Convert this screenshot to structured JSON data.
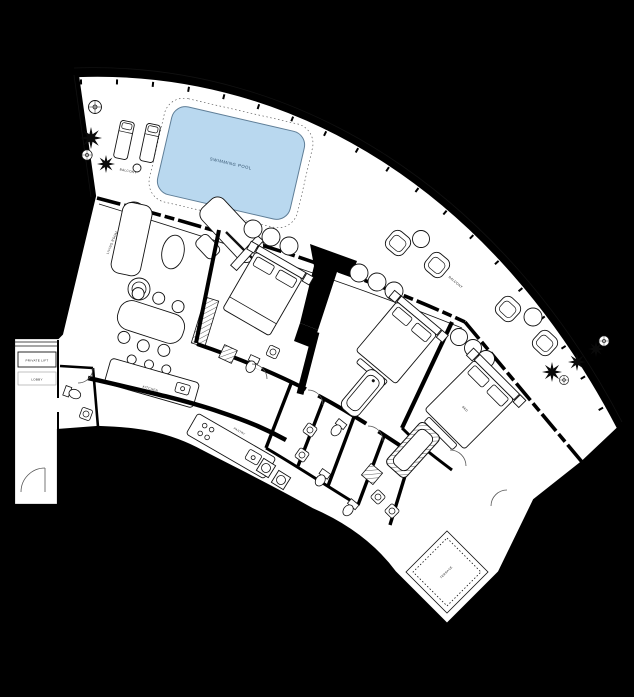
{
  "title": "Curved Apartment Floor Plan",
  "colors": {
    "background": "#000000",
    "floor": "#ffffff",
    "walls": "#000000",
    "pool_fill": "#b9d8ef",
    "pool_stroke": "#5f7e97",
    "label_text": "#222222"
  },
  "labels": {
    "swimming_pool": "SWIMMING POOL",
    "balcony_left": "BALCONY",
    "balcony_right": "BALCONY",
    "living_room": "LIVING ROOM",
    "kitchen": "KITCHEN",
    "pantry": "PANTRY",
    "private_lift": "PRIVATE LIFT",
    "lift_lobby": "LOBBY",
    "master_bed": "BED",
    "terrace": "TERRACE"
  }
}
